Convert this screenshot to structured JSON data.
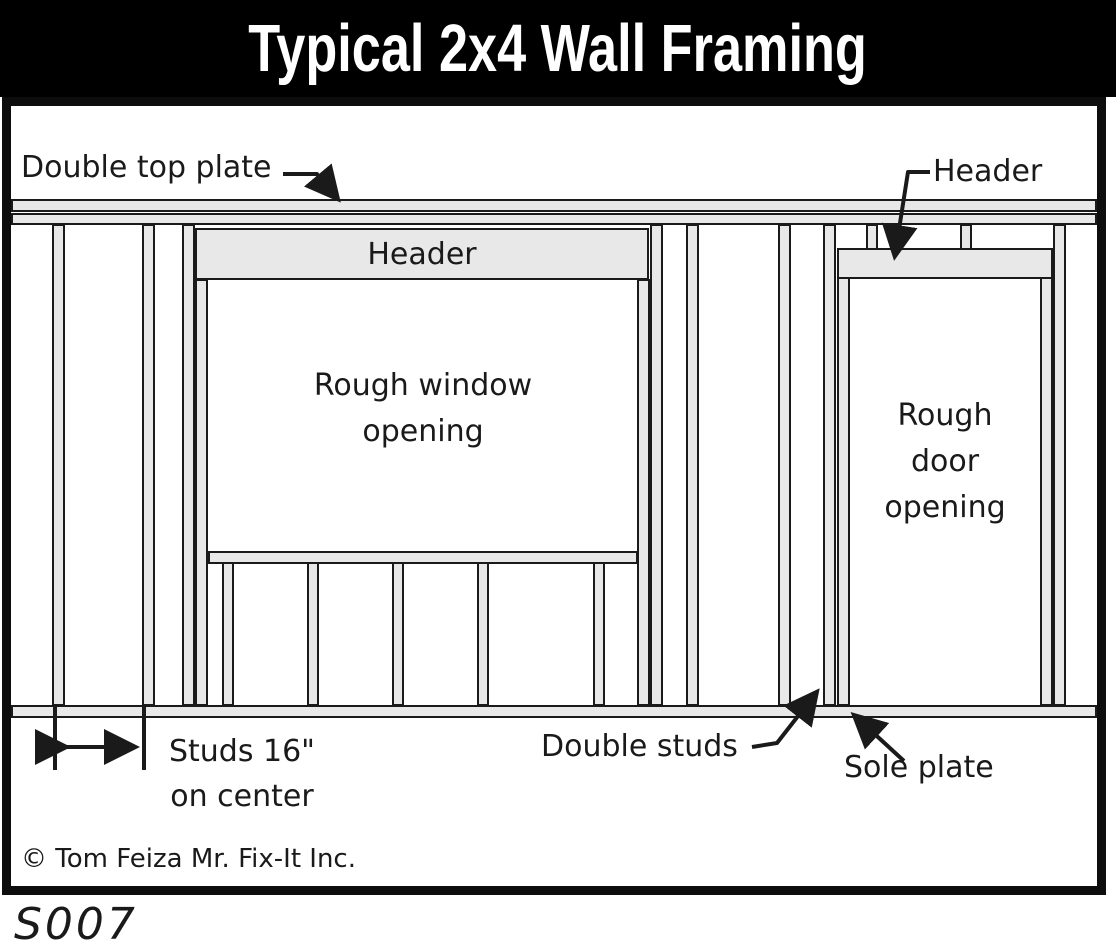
{
  "title": "Typical 2x4 Wall Framing",
  "labels": {
    "double_top_plate": "Double top plate",
    "window_header": "Header",
    "door_header": "Header",
    "window_opening_line1": "Rough window",
    "window_opening_line2": "opening",
    "door_opening_line1": "Rough",
    "door_opening_line2": "door",
    "door_opening_line3": "opening",
    "studs_note_line1": "Studs 16\"",
    "studs_note_line2": "on center",
    "double_studs": "Double studs",
    "sole_plate": "Sole plate"
  },
  "footer": {
    "copyright": "© Tom Feiza Mr. Fix-It Inc.",
    "figure_code": "S007"
  },
  "colors": {
    "title_bg": "#000000",
    "title_fg": "#ffffff",
    "wood_fill": "#e8e8e8",
    "outline": "#1a1a1a",
    "background": "#ffffff"
  }
}
